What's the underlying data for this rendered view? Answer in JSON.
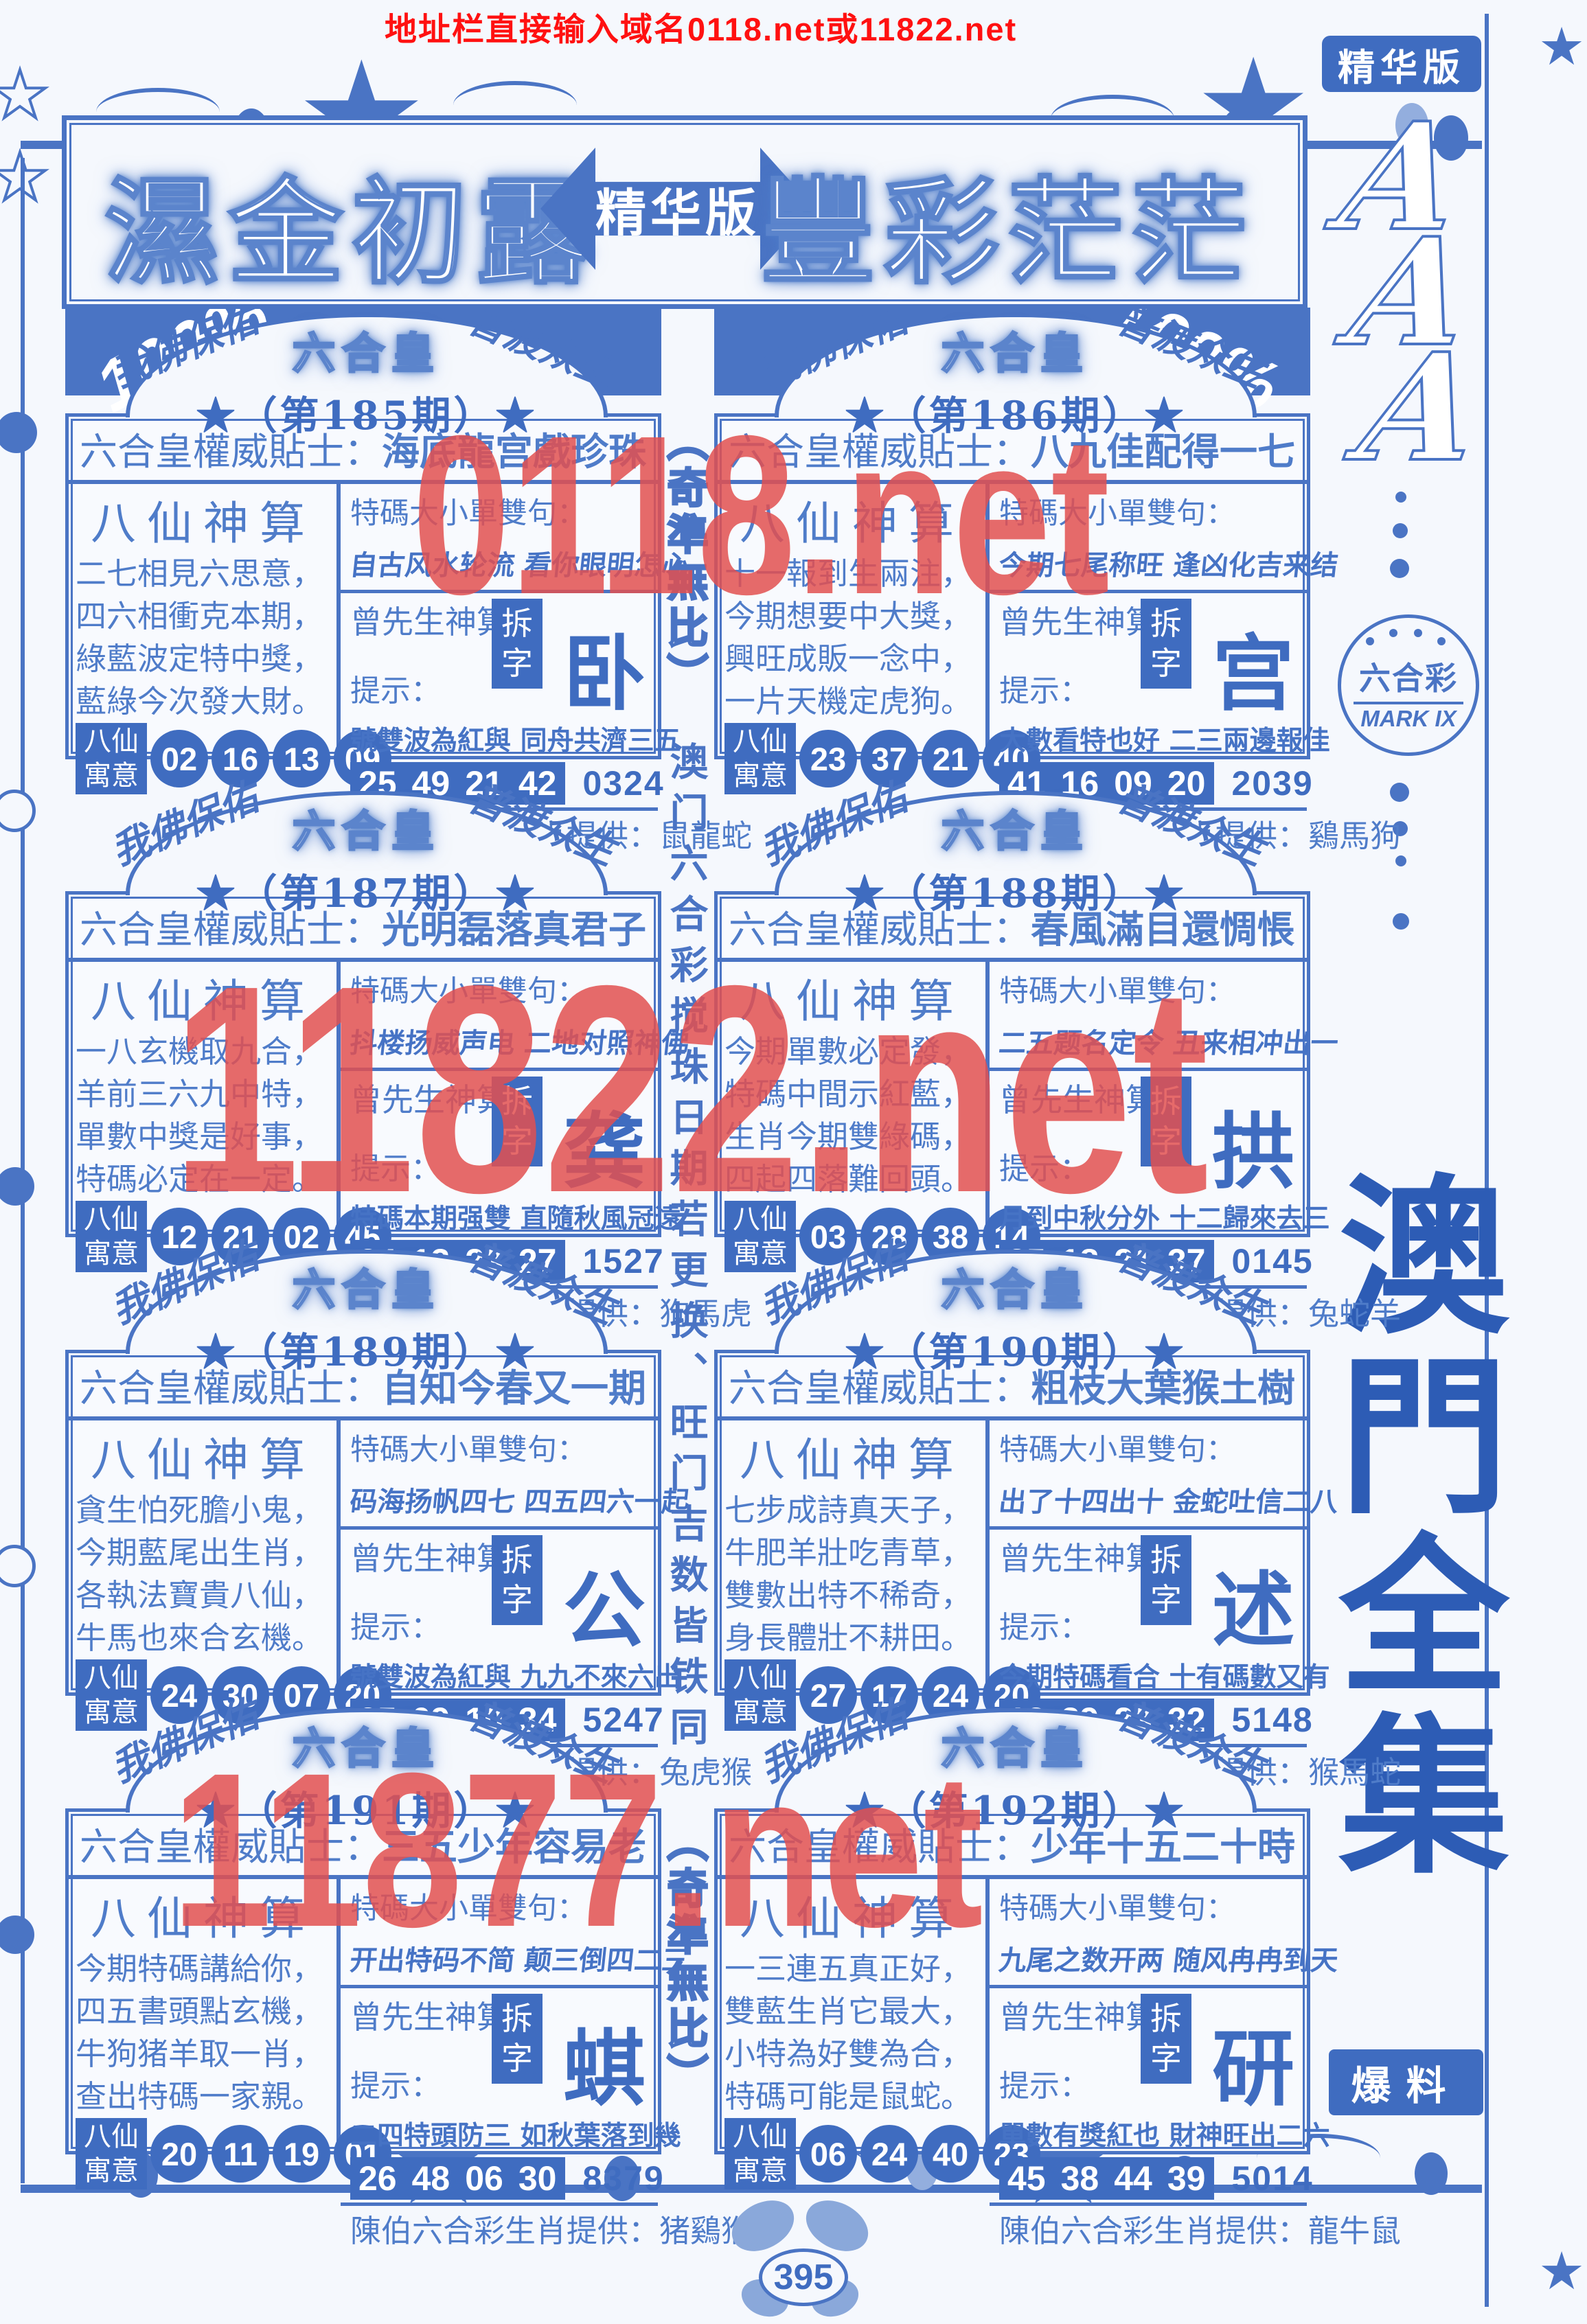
{
  "meta": {
    "top_url": "地址栏直接输入域名0118.net或11822.net",
    "page_number": "395"
  },
  "watermarks": {
    "top": "0118.net",
    "middle": "11822.net",
    "bottom": "11877.net"
  },
  "banner": {
    "left_title": "濕金初露",
    "arrow_label": "精华版",
    "right_title": "豐彩茫茫",
    "percent_badge": "100%"
  },
  "center_column": {
    "top": "（奇準無比）",
    "middle": "澳门六合彩搅珠日期若更换、旺门吉数皆铁同",
    "bottom": "（奇準無比）"
  },
  "sidebar": {
    "top_badge": "精华版",
    "monogram": [
      "A",
      "A",
      "A"
    ],
    "logo_title": "六合彩",
    "logo_mark": "MARK IX",
    "collection_title": "澳門全集",
    "bottom_badge": "爆料"
  },
  "labels": {
    "blessing_left": "我佛保佑",
    "blessing_right": "普渡众生",
    "crown": "六合皇",
    "tip_label": "六合皇權威貼士：",
    "poem_title": "八仙神算",
    "phrase_label": "特碼大小單雙句：",
    "master_label": "曾先生神算：",
    "chai_label": "拆字",
    "hint_label": "提示：",
    "yuyi_top": "八仙",
    "yuyi_bottom": "寓意",
    "animals_label": "陳伯六合彩生肖提供："
  },
  "colors": {
    "blue": "#4a74c4",
    "deep_blue": "#3f6cc0",
    "text_blue": "#4f7cc9",
    "url_red": "#ff1111",
    "watermark_red": "#e25050",
    "bg": "#f5f8fd"
  },
  "panels": [
    {
      "issue": "★（第185期）★",
      "tip": "海底龍宫戲珍珠",
      "poem": [
        "二七相見六思意，",
        "四六相衝克本期，",
        "綠藍波定特中獎，",
        "藍綠今次發大財。"
      ],
      "phrase": "自古风水轮流 看你眼明怎心",
      "chai": "卧",
      "hint": "號雙波為紅與 同舟共濟三五",
      "nums": [
        "25",
        "49",
        "21",
        "42"
      ],
      "code": "0324",
      "yuyi": [
        "02",
        "16",
        "13",
        "09"
      ],
      "animals": "鼠龍蛇"
    },
    {
      "issue": "★（第186期）★",
      "tip": "八九佳配得一七",
      "poem": [
        "十一報到生兩注，",
        "今期想要中大獎，",
        "興旺成販一念中，",
        "一片天機定虎狗。"
      ],
      "phrase": "今期七尾称旺 逢凶化吉来结",
      "chai": "宫",
      "hint": "大數看特也好 二三兩邊報佳",
      "nums": [
        "41",
        "16",
        "09",
        "20"
      ],
      "code": "2039",
      "yuyi": [
        "23",
        "37",
        "21",
        "40"
      ],
      "animals": "鷄馬狗"
    },
    {
      "issue": "★（第187期）★",
      "tip": "光明磊落真君子",
      "poem": [
        "一八玄機取九合，",
        "羊前三六九中特，",
        "單數中獎是好事，",
        "特碼必定在一定。"
      ],
      "phrase": "抖楼扬威声电 二地对照神佛",
      "chai": "龚",
      "hint": "特碼本期强雙 直隨秋風冠遠",
      "nums": [
        "24",
        "13",
        "23",
        "27"
      ],
      "code": "1527",
      "yuyi": [
        "12",
        "21",
        "02",
        "45"
      ],
      "animals": "狗馬虎"
    },
    {
      "issue": "★（第188期）★",
      "tip": "春風滿目還惆悵",
      "poem": [
        "今期單數必定發，",
        "特碼中間示紅藍，",
        "生肖今期雙綠碼，",
        "四起四落難回頭。"
      ],
      "phrase": "二五题名定令 丑来相冲出一",
      "chai": "拱",
      "hint": "月到中秋分外 十二歸來去三",
      "nums": [
        "25",
        "18",
        "21",
        "37"
      ],
      "code": "0145",
      "yuyi": [
        "03",
        "28",
        "38",
        "14"
      ],
      "animals": "兔蛇羊"
    },
    {
      "issue": "★（第189期）★",
      "tip": "自知今春又一期",
      "poem": [
        "貪生怕死膽小鬼，",
        "今期藍尾出生肖，",
        "各執法寶貴八仙，",
        "牛馬也來合玄機。"
      ],
      "phrase": "码海扬帆四七 四五四六一起",
      "chai": "公",
      "hint": "號雙波為紅與 九九不來六出",
      "nums": [
        "35",
        "09",
        "10",
        "34"
      ],
      "code": "5247",
      "yuyi": [
        "24",
        "30",
        "07",
        "20"
      ],
      "animals": "兔虎猴"
    },
    {
      "issue": "★（第190期）★",
      "tip": "粗枝大葉猴土樹",
      "poem": [
        "七步成詩真天子，",
        "牛肥羊壯吃青草，",
        "雙數出特不稀奇，",
        "身長體壯不耕田。"
      ],
      "phrase": "出了十四出十 金蛇吐信二八",
      "chai": "述",
      "hint": "今期特碼看合 十有碼數又有",
      "nums": [
        "13",
        "29",
        "23",
        "32"
      ],
      "code": "5148",
      "yuyi": [
        "27",
        "17",
        "24",
        "20"
      ],
      "animals": "猴馬蛇"
    },
    {
      "issue": "★（第191期）★",
      "tip": "三五少年容易老",
      "poem": [
        "今期特碼講給你，",
        "四五書頭點玄機，",
        "牛狗猪羊取一肖，",
        "查出特碼一家親。"
      ],
      "phrase": "开出特码不简 颠三倒四二三",
      "chai": "蜞",
      "hint": "二四特頭防三 如秋葉落到幾",
      "nums": [
        "26",
        "48",
        "06",
        "30"
      ],
      "code": "8379",
      "yuyi": [
        "20",
        "11",
        "19",
        "01"
      ],
      "animals": "猪鷄猴"
    },
    {
      "issue": "★（第192期）★",
      "tip": "少年十五二十時",
      "poem": [
        "一三連五真正好，",
        "雙藍生肖它最大，",
        "小特為好雙為合，",
        "特碼可能是鼠蛇。"
      ],
      "phrase": "九尾之数开两 随风冉冉到天",
      "chai": "研",
      "hint": "單數有獎紅也 財神旺出二六",
      "nums": [
        "45",
        "38",
        "44",
        "39"
      ],
      "code": "5014",
      "yuyi": [
        "06",
        "24",
        "40",
        "23"
      ],
      "animals": "龍牛鼠"
    }
  ]
}
